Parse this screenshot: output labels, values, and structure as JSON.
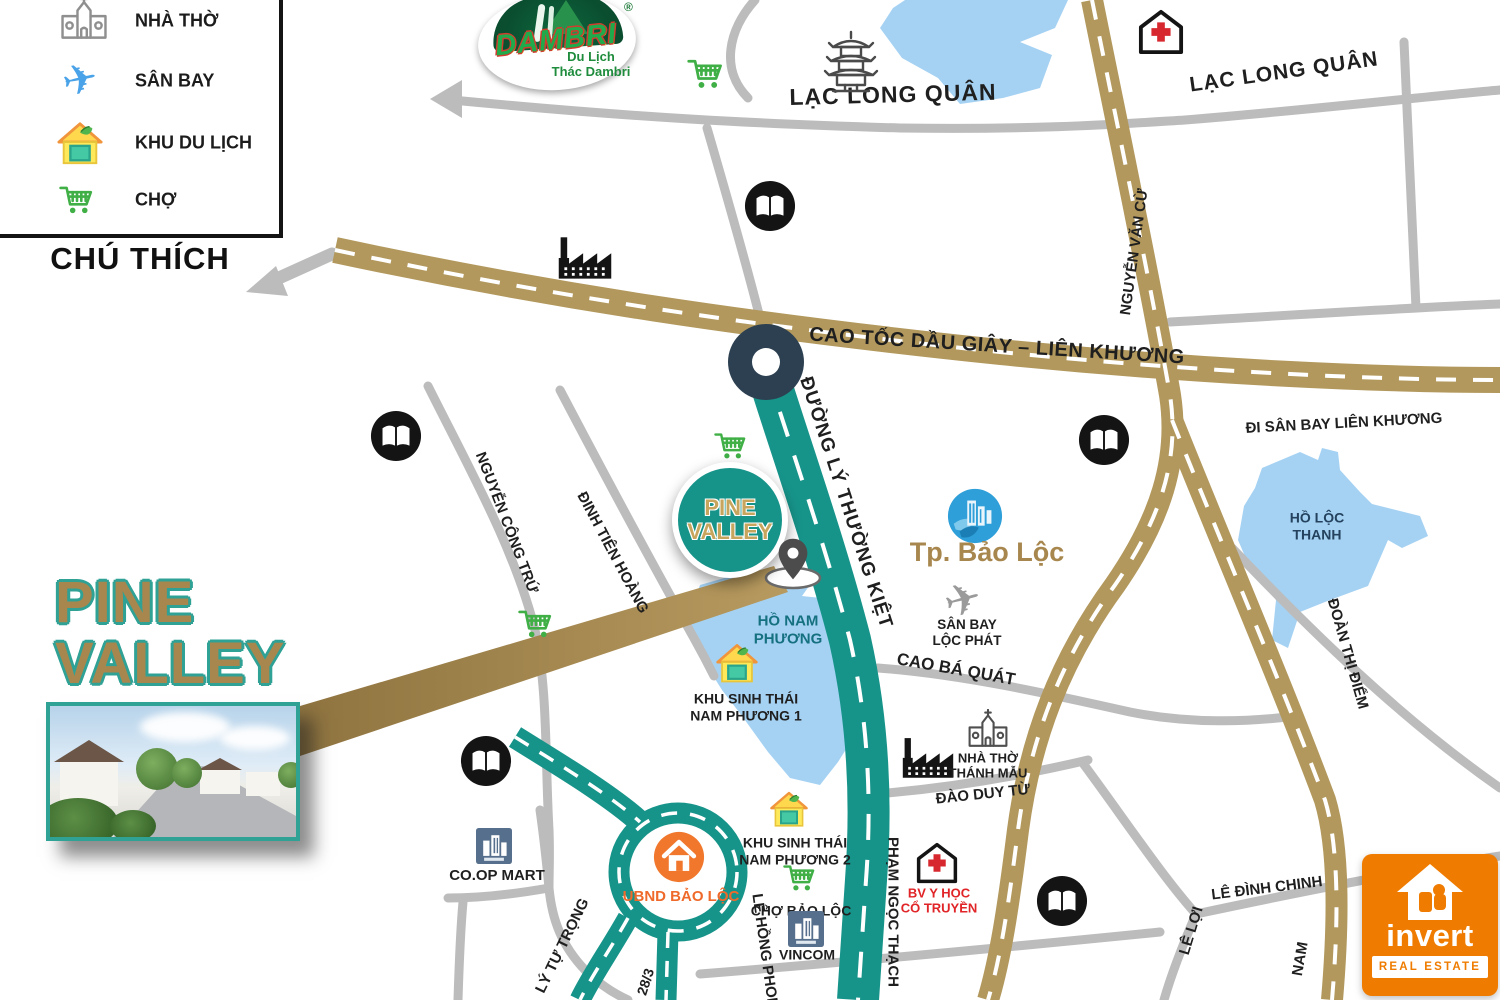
{
  "legend": {
    "title": "CHÚ THÍCH",
    "items": [
      {
        "icon": "church-icon",
        "label": "NHÀ THỜ"
      },
      {
        "icon": "airplane-icon",
        "label": "SÂN BAY"
      },
      {
        "icon": "tourism-area-icon",
        "label": "KHU DU LỊCH"
      },
      {
        "icon": "market-cart-icon",
        "label": "CHỢ"
      }
    ]
  },
  "logos": {
    "dambri": {
      "name": "DAMBRI",
      "registered": "®",
      "tagline1": "Du Lịch",
      "tagline2": "Thác Dambri"
    },
    "invert": {
      "name": "invert",
      "tagline": "REAL ESTATE"
    }
  },
  "project": {
    "title_line1": "PINE",
    "title_line2": "VALLEY",
    "badge_line1": "PINE",
    "badge_line2": "VALLEY"
  },
  "city": {
    "label": "Tp. Bảo Lộc"
  },
  "roads": {
    "lac_long_quan_center": "LẠC LONG QUÂN",
    "lac_long_quan_east": "LẠC LONG QUÂN",
    "cao_toc": "CAO TỐC DẦU GIÂY – LIÊN KHƯƠNG",
    "ly_thuong_kiet": "ĐƯỜNG LÝ THƯỜNG KIỆT",
    "di_san_bay": "ĐI SÂN BAY LIÊN KHƯƠNG",
    "nguyen_van_cu": "NGUYỄN VĂN CỪ",
    "cao_ba_quat": "CAO BÁ QUÁT",
    "dao_duy_tu": "ĐÀO DUY TỪ",
    "doan_thi_diem": "ĐOÀN THỊ ĐIỂM",
    "nguyen_cong_tru": "NGUYỄN CÔNG TRỨ",
    "dinh_tien_hoang": "ĐINH TIÊN HOÀNG",
    "ly_tu_trong": "LÝ TỰ TRỌNG",
    "le_hong_phong": "LÊ HỒNG PHONG",
    "pham_ngoc_thach": "PHẠM NGỌC THẠCH",
    "le_dinh_chinh": "LÊ ĐÌNH CHINH",
    "le_loi": "LÊ LỢI",
    "nam": "NAM",
    "duong_28_3": "28/3"
  },
  "places": {
    "san_bay_loc_phat": {
      "line1": "SÂN BAY",
      "line2": "LỘC PHÁT"
    },
    "khu_sinh_thai_1": {
      "line1": "KHU SINH THÁI",
      "line2": "NAM PHƯƠNG 1"
    },
    "khu_sinh_thai_2": {
      "line1": "KHU SINH THÁI",
      "line2": "NAM PHƯƠNG 2"
    },
    "cho_bao_loc": "CHỢ BẢO LỘC",
    "vincom": "VINCOM",
    "ubnd_bao_loc": "UBND BẢO LỘC",
    "nha_tho_thanh_mau": {
      "line1": "NHÀ THỜ",
      "line2": "THÁNH MẪU"
    },
    "bv_y_hoc": {
      "line1": "BV Y HỌC",
      "line2": "CỔ TRUYỀN"
    },
    "coop_mart": "CO.OP MART"
  },
  "lakes": {
    "ho_nam_phuong": {
      "line1": "HỒ NAM",
      "line2": "PHƯƠNG"
    },
    "ho_loc_thanh": {
      "line1": "HỒ LỘC",
      "line2": "THANH"
    }
  },
  "colors": {
    "teal_road": "#17948a",
    "gold_road": "#b2985c",
    "gray_road": "#bcbcbc",
    "lake_blue": "#a5d2f3",
    "gold_text": "#a8874e",
    "ubnd_orange": "#ef6a2a",
    "invert_orange": "#ef7c00",
    "hospital_red": "#d7282f",
    "market_green": "#3faf46",
    "roundabout_navy": "#2c4051"
  }
}
